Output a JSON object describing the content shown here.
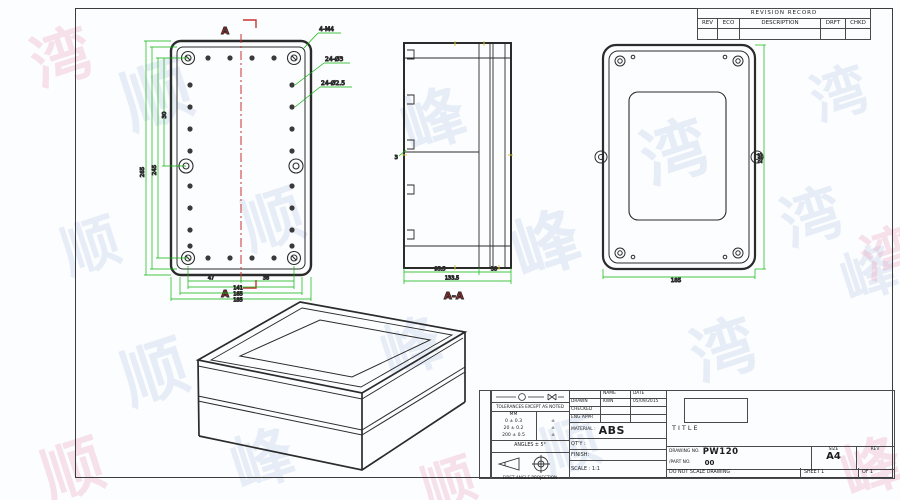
{
  "watermark": {
    "glyphs": [
      "顺",
      "峰",
      "湾",
      "顺",
      "峰",
      "湾",
      "顺",
      "峰",
      "湾",
      "顺",
      "峰",
      "湾",
      "顺",
      "峰",
      "湾",
      "顺",
      "峰",
      "湾",
      "顺"
    ]
  },
  "revision_table": {
    "title": "REVISION RECORD",
    "columns": [
      "REV",
      "ECO",
      "DESCRIPTION",
      "DRFT",
      "CHKD"
    ]
  },
  "drawing": {
    "front": {
      "marker_top": "A",
      "marker_bottom": "A",
      "callout_corner": "4-M4",
      "callout_hole_outer": "24-Ø3",
      "callout_hole_inner": "24-Ø2.5",
      "dim_inner_a": "47",
      "dim_inner_b": "38",
      "dim_w1": "141",
      "dim_w2": "165",
      "dim_w3": "185",
      "dim_pitch": "30",
      "dim_h1": "245",
      "dim_h2": "265"
    },
    "section": {
      "label": "A-A",
      "dim_wall": "3",
      "dim_base": "95.5",
      "dim_overall": "133.5",
      "dim_lid": "38"
    },
    "back": {
      "dim_height": "265",
      "dim_width": "185"
    }
  },
  "title_block": {
    "tolerance_heading": "TOLERANCES EXCEPT AS NOTED",
    "tolerance_unit": "MM",
    "tolerance_rows": [
      "0 ± 0.3",
      "20 ± 0.2",
      "200 ± 0.5"
    ],
    "tolerance_marks": [
      "±",
      "±",
      "±"
    ],
    "angles": "ANGLES ± 5°",
    "projection": "FIRST ANGLE PROJECTION",
    "name_header": "NAME",
    "date_header": "DATE",
    "drawn_label": "DRAWN",
    "drawn_name": "KWN",
    "drawn_date": "05/09/2015",
    "checked_label": "CHECKED",
    "eng_appr_label": "ENG APPR",
    "material_label": "MATERIAL :",
    "material_value": "ABS",
    "qty_label": "QT'Y :",
    "finish_label": "FINISH:",
    "scale_label": "SCALE : 1:1",
    "title_label": "TITLE",
    "drawing_no_label": "DRAWING NO.",
    "drawing_no_value": "PW120",
    "part_no_label": "/PART NO.",
    "part_no_value": "00",
    "size_label": "SIZE",
    "size_value": "A4",
    "rev_label": "REV",
    "no_scale_note": "DO NOT SCALE DRAWING",
    "sheet_info": "SHEET 1",
    "of_info": "OF 1"
  }
}
